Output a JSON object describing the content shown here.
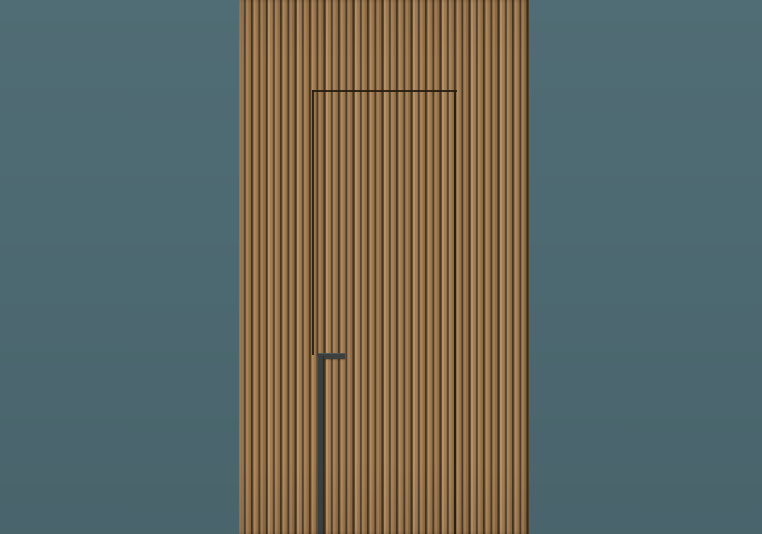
{
  "scene": {
    "description": "Concealed flush interior door integrated into a wall of vertical wood slat panelling (light oak), with thin shadow-gap seams outlining the door and a black recessed L-shaped pull handle whose vertical channel runs down to the floor, set against a muted teal-grey backdrop",
    "colors": {
      "background": "#4d6971",
      "slat_face": "#b18a5e",
      "slat_face_dark": "#9c7649",
      "slat_edge": "#8a6840",
      "groove": "#4a3826",
      "groove_light": "#6d5436",
      "seam": "#261d12",
      "handle": "#3b403e"
    },
    "elements": {
      "panel": "vertical-wood-slat-panel",
      "door": "hidden-door-seam-outline",
      "handle": "recessed-black-pull-handle"
    }
  }
}
